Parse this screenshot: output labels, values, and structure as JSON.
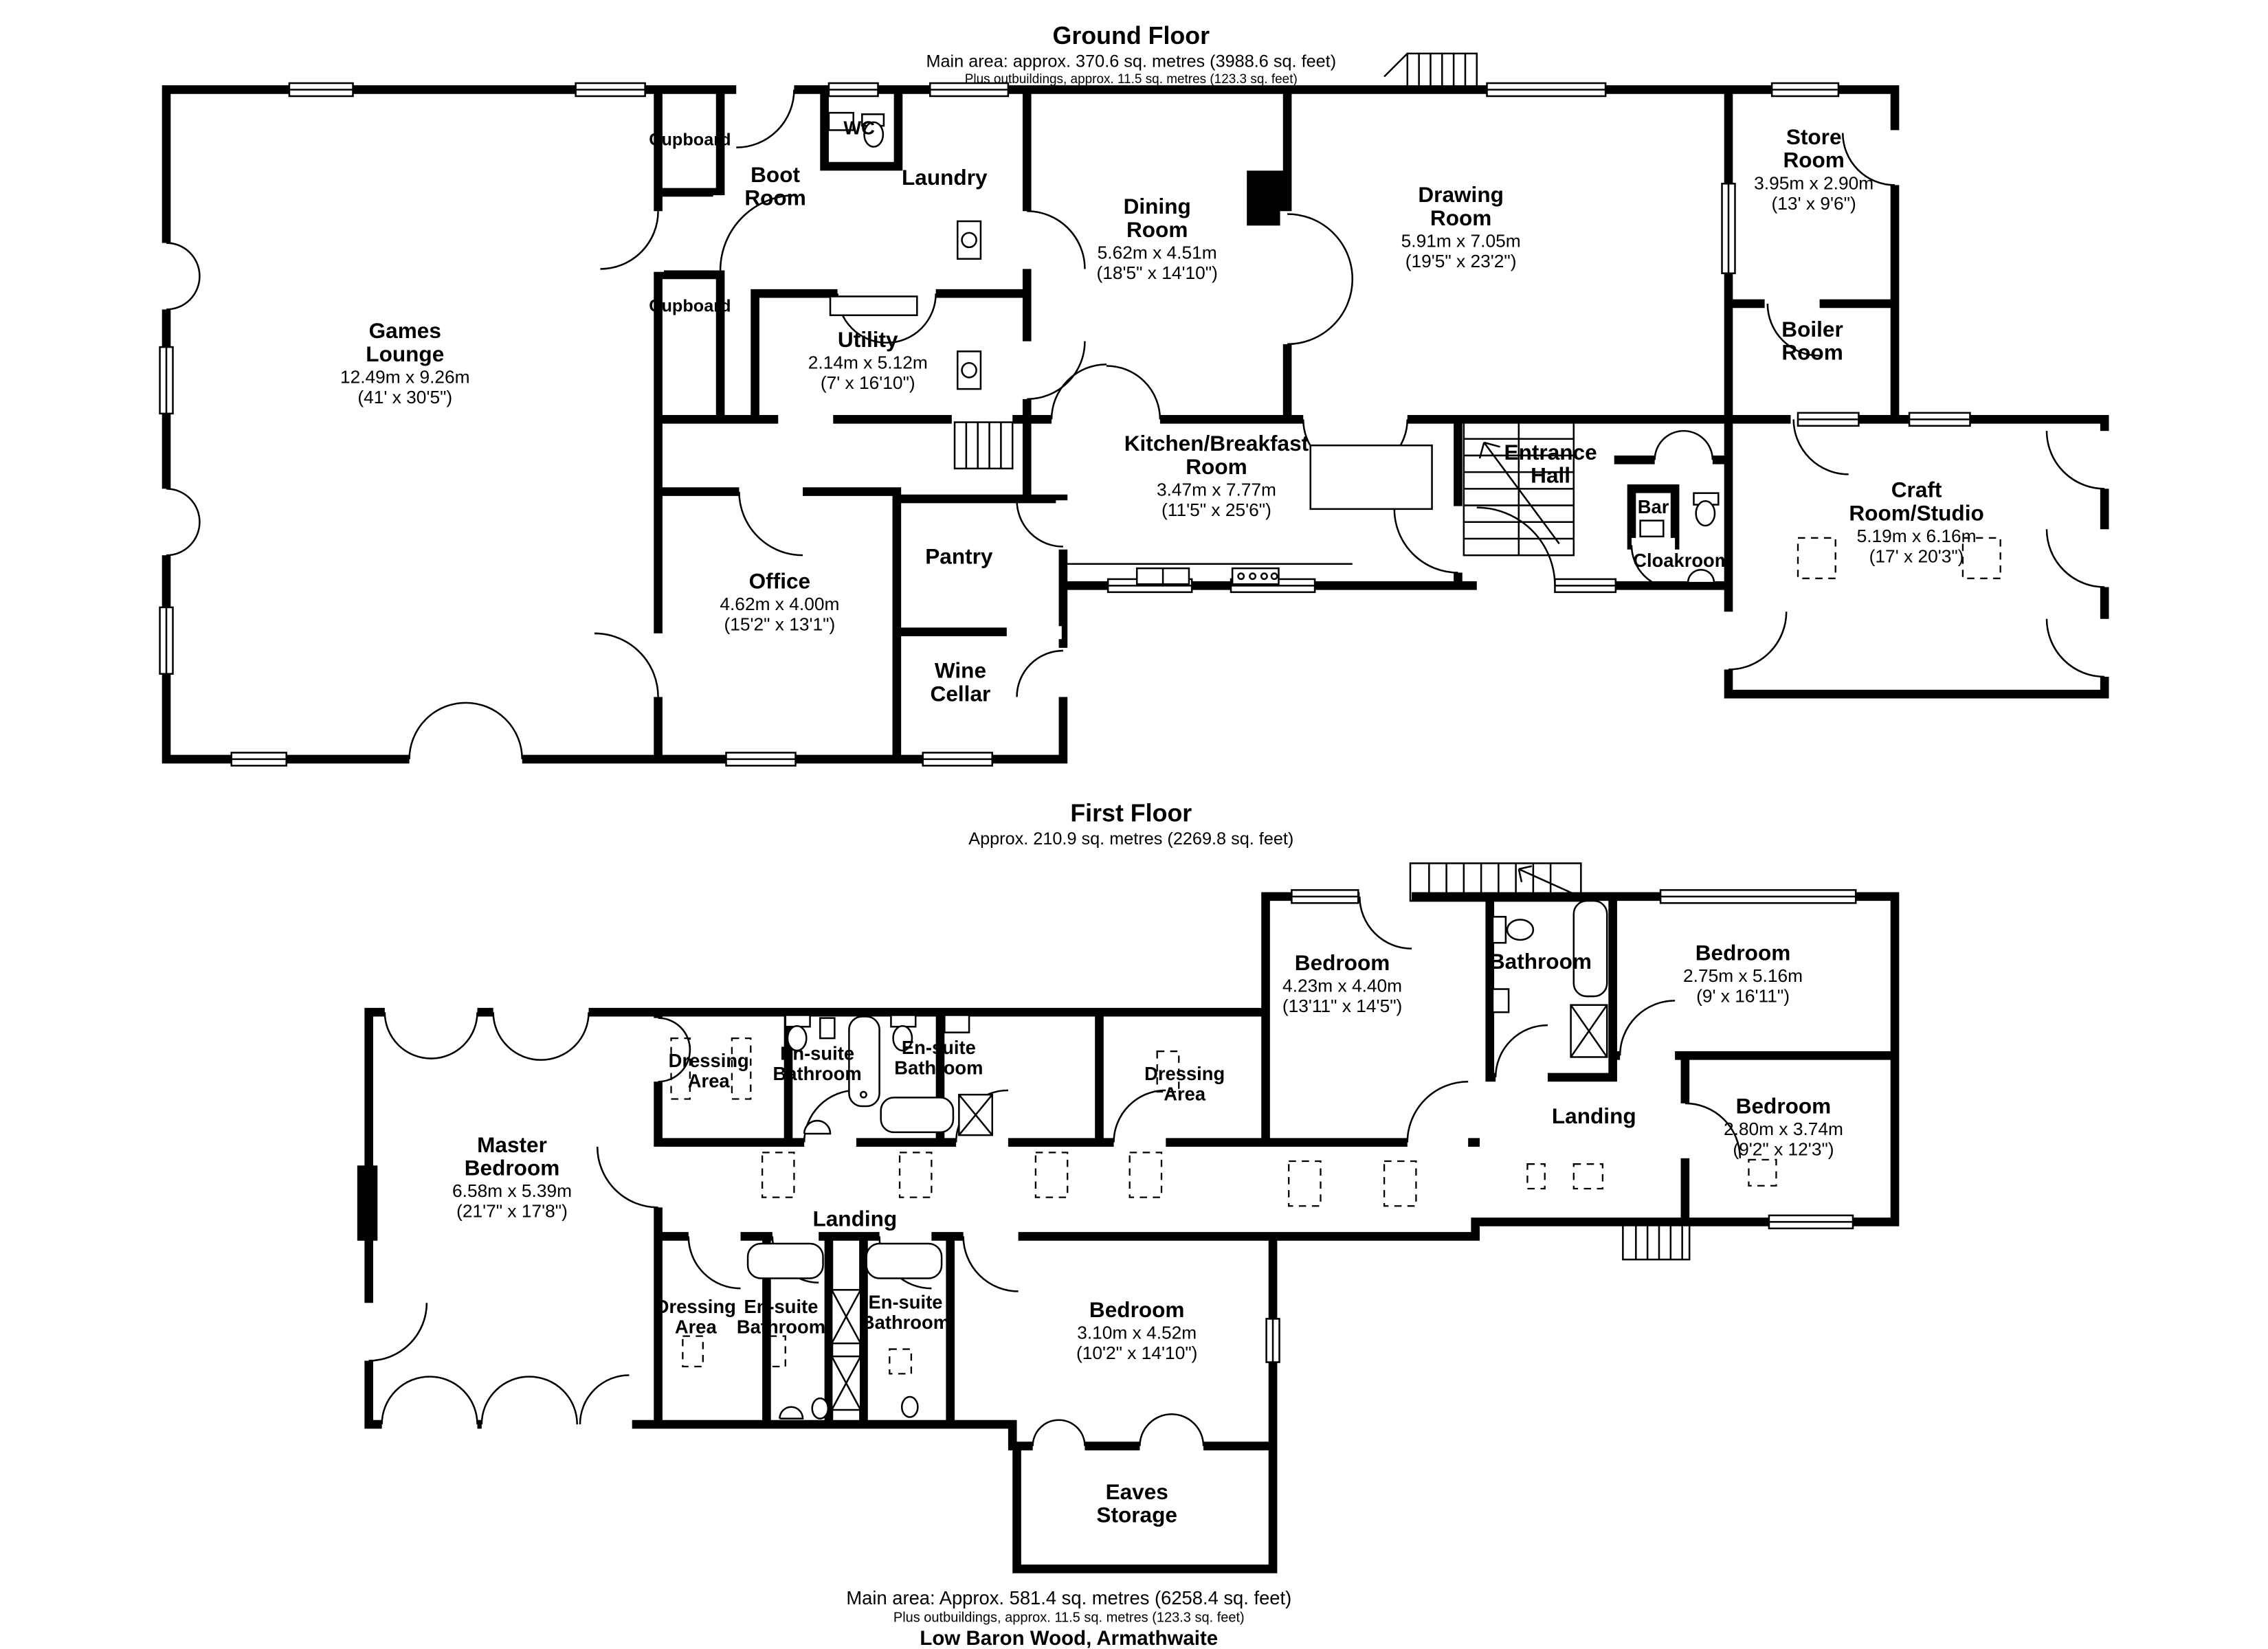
{
  "ground_floor": {
    "title": "Ground Floor",
    "area_line": "Main area: approx. 370.6 sq. metres (3988.6 sq. feet)",
    "outbuildings_line": "Plus outbuildings, approx. 11.5 sq. metres (123.3 sq. feet)",
    "rooms": {
      "games_lounge": {
        "name": "Games Lounge",
        "metric": "12.49m x 9.26m",
        "imperial": "(41' x 30'5\")"
      },
      "cupboard_top": {
        "name": "Cupboard"
      },
      "boot_room": {
        "name": "Boot Room"
      },
      "wc": {
        "name": "WC"
      },
      "laundry": {
        "name": "Laundry"
      },
      "cupboard_bottom": {
        "name": "Cupboard"
      },
      "utility": {
        "name": "Utility",
        "metric": "2.14m x 5.12m",
        "imperial": "(7' x 16'10\")"
      },
      "dining_room": {
        "name": "Dining Room",
        "metric": "5.62m x 4.51m",
        "imperial": "(18'5\" x 14'10\")"
      },
      "drawing_room": {
        "name": "Drawing Room",
        "metric": "5.91m x 7.05m",
        "imperial": "(19'5\" x 23'2\")"
      },
      "store_room": {
        "name": "Store Room",
        "metric": "3.95m x 2.90m",
        "imperial": "(13' x 9'6\")"
      },
      "boiler_room": {
        "name": "Boiler Room"
      },
      "kitchen_breakfast": {
        "name": "Kitchen/Breakfast Room",
        "metric": "3.47m x 7.77m",
        "imperial": "(11'5\" x 25'6\")"
      },
      "entrance_hall": {
        "name": "Entrance Hall"
      },
      "bar": {
        "name": "Bar"
      },
      "cloakroom": {
        "name": "Cloakroom"
      },
      "craft_room": {
        "name": "Craft Room/Studio",
        "metric": "5.19m x 6.16m",
        "imperial": "(17' x 20'3\")"
      },
      "office": {
        "name": "Office",
        "metric": "4.62m x 4.00m",
        "imperial": "(15'2\" x 13'1\")"
      },
      "pantry": {
        "name": "Pantry"
      },
      "wine_cellar": {
        "name": "Wine Cellar"
      }
    }
  },
  "first_floor": {
    "title": "First Floor",
    "area_line": "Approx. 210.9 sq. metres (2269.8 sq. feet)",
    "rooms": {
      "master_bedroom": {
        "name": "Master Bedroom",
        "metric": "6.58m x 5.39m",
        "imperial": "(21'7\" x 17'8\")"
      },
      "dressing_area_1": {
        "name": "Dressing Area"
      },
      "ensuite_1": {
        "name": "En-suite Bathroom"
      },
      "ensuite_2": {
        "name": "En-suite Bathroom"
      },
      "dressing_area_2": {
        "name": "Dressing Area"
      },
      "bedroom_1": {
        "name": "Bedroom",
        "metric": "4.23m x 4.40m",
        "imperial": "(13'11\" x 14'5\")"
      },
      "bathroom": {
        "name": "Bathroom"
      },
      "bedroom_2": {
        "name": "Bedroom",
        "metric": "2.75m x 5.16m",
        "imperial": "(9' x 16'11\")"
      },
      "bedroom_3": {
        "name": "Bedroom",
        "metric": "2.80m x 3.74m",
        "imperial": "(9'2\" x 12'3\")"
      },
      "landing_right": {
        "name": "Landing"
      },
      "landing_center": {
        "name": "Landing"
      },
      "dressing_area_3": {
        "name": "Dressing Area"
      },
      "ensuite_3": {
        "name": "En-suite Bathroom"
      },
      "ensuite_4": {
        "name": "En-suite Bathroom"
      },
      "bedroom_4": {
        "name": "Bedroom",
        "metric": "3.10m x 4.52m",
        "imperial": "(10'2\" x 14'10\")"
      },
      "eaves_storage": {
        "name": "Eaves Storage"
      }
    }
  },
  "footer": {
    "main_area": "Main area: Approx. 581.4 sq. metres (6258.4 sq. feet)",
    "outbuildings": "Plus outbuildings, approx. 11.5 sq. metres (123.3 sq. feet)",
    "address": "Low Baron Wood, Armathwaite"
  }
}
